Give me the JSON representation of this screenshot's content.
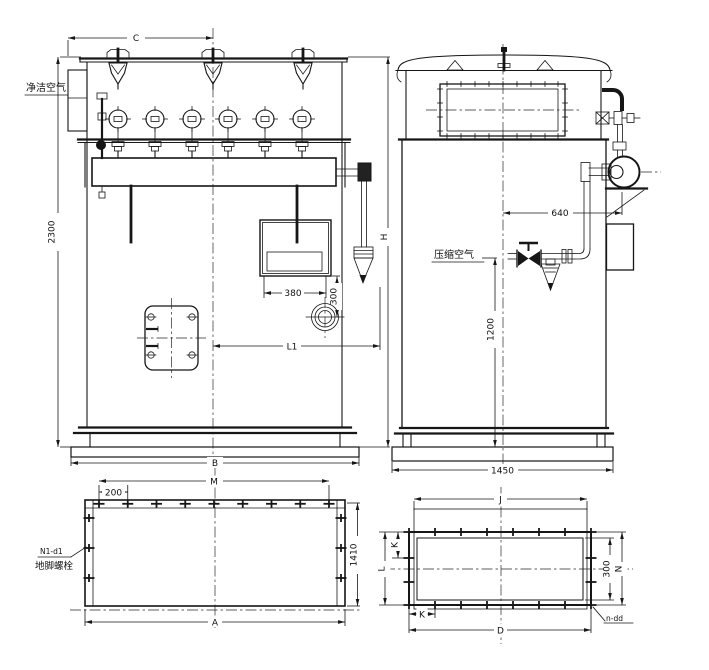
{
  "labels": {
    "clean_air": "净洁空气",
    "compressed_air": "压缩空气",
    "anchor_bolt_code": "N1-d1",
    "anchor_bolt_name": "地脚螺栓",
    "flange_bolt_code": "n-dd"
  },
  "dims": {
    "front": {
      "top_width": "C",
      "height": "2300",
      "height_right": "H",
      "control_box_width": "380",
      "gauge_offset": "300",
      "center_to_inlet": "L1",
      "base_width": "B"
    },
    "side": {
      "center_to_pipe": "640",
      "inlet_height": "1200",
      "base_depth": "1450"
    },
    "foundation": {
      "bolt_pitch": "200",
      "bolt_span": "M",
      "depth": "1410",
      "width": "A"
    },
    "flange": {
      "top_width": "J",
      "corner_pitch_side": "K",
      "corner_pitch_bottom": "K",
      "opening_height": "300",
      "flange_height": "N",
      "side_height": "L",
      "width": "D"
    }
  }
}
